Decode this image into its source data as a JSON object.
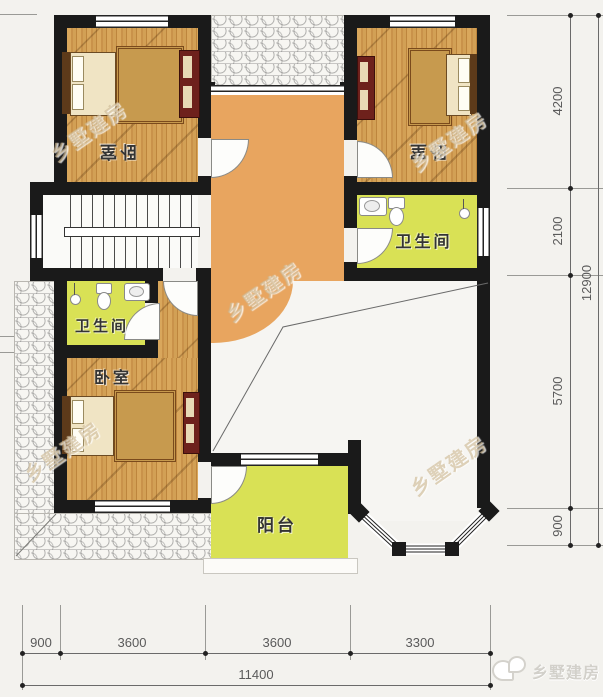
{
  "rooms": {
    "bedroom_top_left": "卧室",
    "bedroom_top_right": "卧室",
    "bedroom_bottom": "卧室",
    "bath_right": "卫生间",
    "bath_left": "卫生间",
    "balcony": "阳台"
  },
  "dims_right": {
    "segments": [
      "4200",
      "2100",
      "5700",
      "900"
    ],
    "total": "12900"
  },
  "dims_bottom": {
    "segments": [
      "900",
      "3600",
      "3600",
      "3300"
    ],
    "total": "11400"
  },
  "watermark": {
    "text": "乡墅建房"
  },
  "brand": {
    "text": "乡墅建房"
  },
  "colors": {
    "wall": "#1a1a1a",
    "wood_floor": "#cf9c50",
    "hall_floor": "#e8a55f",
    "wet_room_floor": "#d9e155",
    "dim_text": "#5a5a5a",
    "background": "#f3f2ee"
  }
}
